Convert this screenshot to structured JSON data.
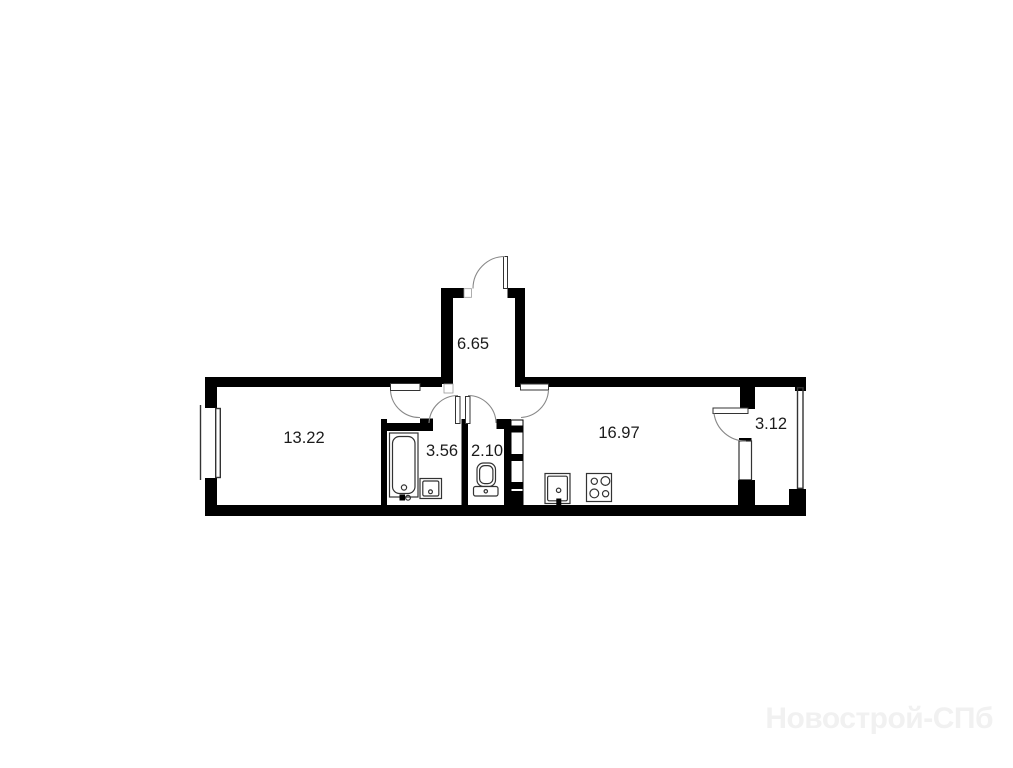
{
  "plan": {
    "type": "apartment-floor-plan",
    "rooms": [
      {
        "id": "hallway",
        "area_label": "6.65"
      },
      {
        "id": "living-room",
        "area_label": "13.22"
      },
      {
        "id": "bathroom",
        "area_label": "3.56"
      },
      {
        "id": "wc",
        "area_label": "2.10"
      },
      {
        "id": "kitchen-living",
        "area_label": "16.97"
      },
      {
        "id": "balcony",
        "area_label": "3.12"
      }
    ],
    "fixtures": [
      "bathtub",
      "bathroom-sink",
      "toilet",
      "kitchen-sink",
      "stove",
      "vent-shaft"
    ],
    "openings": [
      "entrance-door",
      "living-room-door",
      "bathroom-door",
      "wc-door",
      "kitchen-door",
      "balcony-door",
      "living-room-window",
      "balcony-window",
      "balcony-glazing"
    ]
  },
  "watermark": {
    "text": "Новострой-СПб"
  },
  "colors": {
    "background": "#ffffff",
    "wall": "#000000",
    "fixture_line": "#333333",
    "arc_line": "#888888",
    "label_text": "#1b1b1b",
    "watermark_text": "#f1f1f1"
  }
}
